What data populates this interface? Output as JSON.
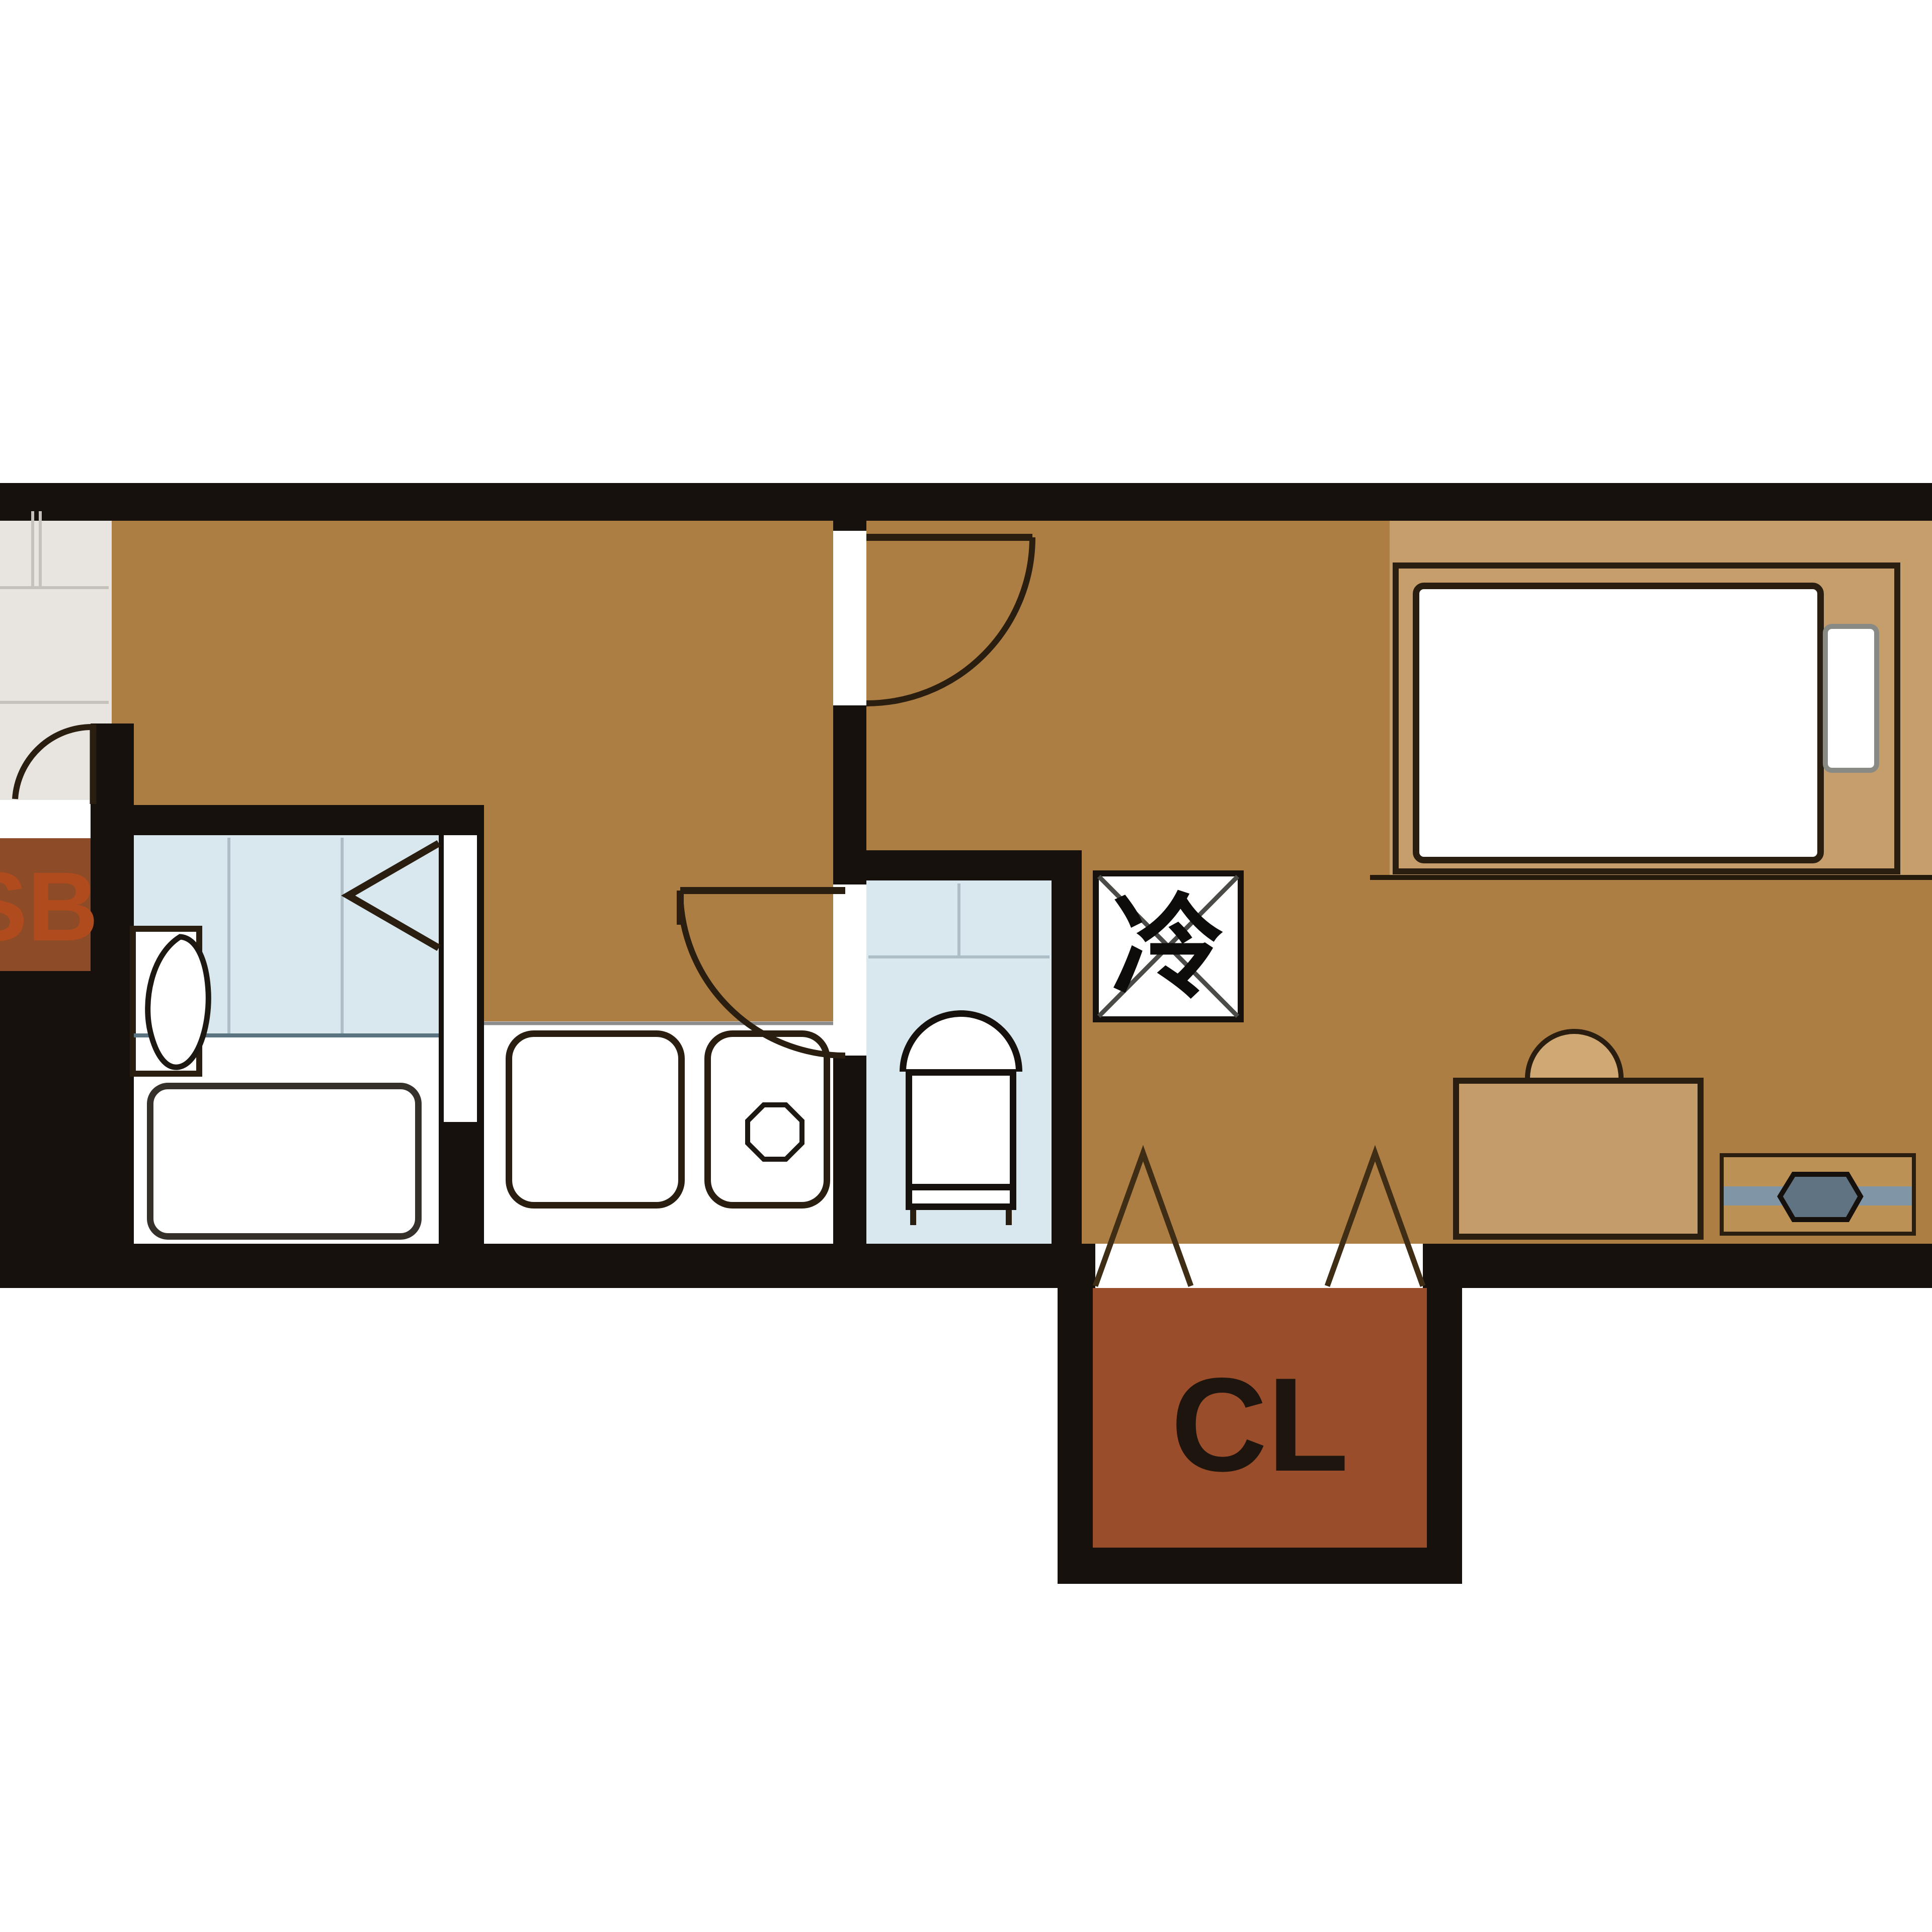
{
  "labels": {
    "shoe_box": "SB",
    "closet": "CL",
    "refrigerator": "冷"
  },
  "colors": {
    "floor": "#ad7e43",
    "floor_light": "#c59e6b",
    "wall": "#16110c",
    "water": "#d9e8ee",
    "tile": "#e8e5e1",
    "closet_fill": "#9a4d2b",
    "sb_fill": "#8e4b27",
    "sb_text": "#b04b1d",
    "cl_text": "#1d150e",
    "outline": "#2a1e10",
    "band_grey": "#8095a6",
    "tv_grey": "#5f7383",
    "chair_fill": "#cfa873",
    "stand_fill": "#bb9156",
    "desk_fill": "#c49c6a"
  },
  "icons": [
    "entrance-door-swing-icon",
    "bedroom-door-swing-icon",
    "toilet-door-swing-icon",
    "folding-door-icon",
    "bathtub-icon",
    "washbasin-icon",
    "toilet-icon",
    "kitchen-sink-icon",
    "sink-drain-icon",
    "refrigerator-box-icon",
    "bed-icon",
    "pillow-icon",
    "desk-icon",
    "chair-icon",
    "tv-board-icon",
    "closet-fold-marks-icon"
  ]
}
